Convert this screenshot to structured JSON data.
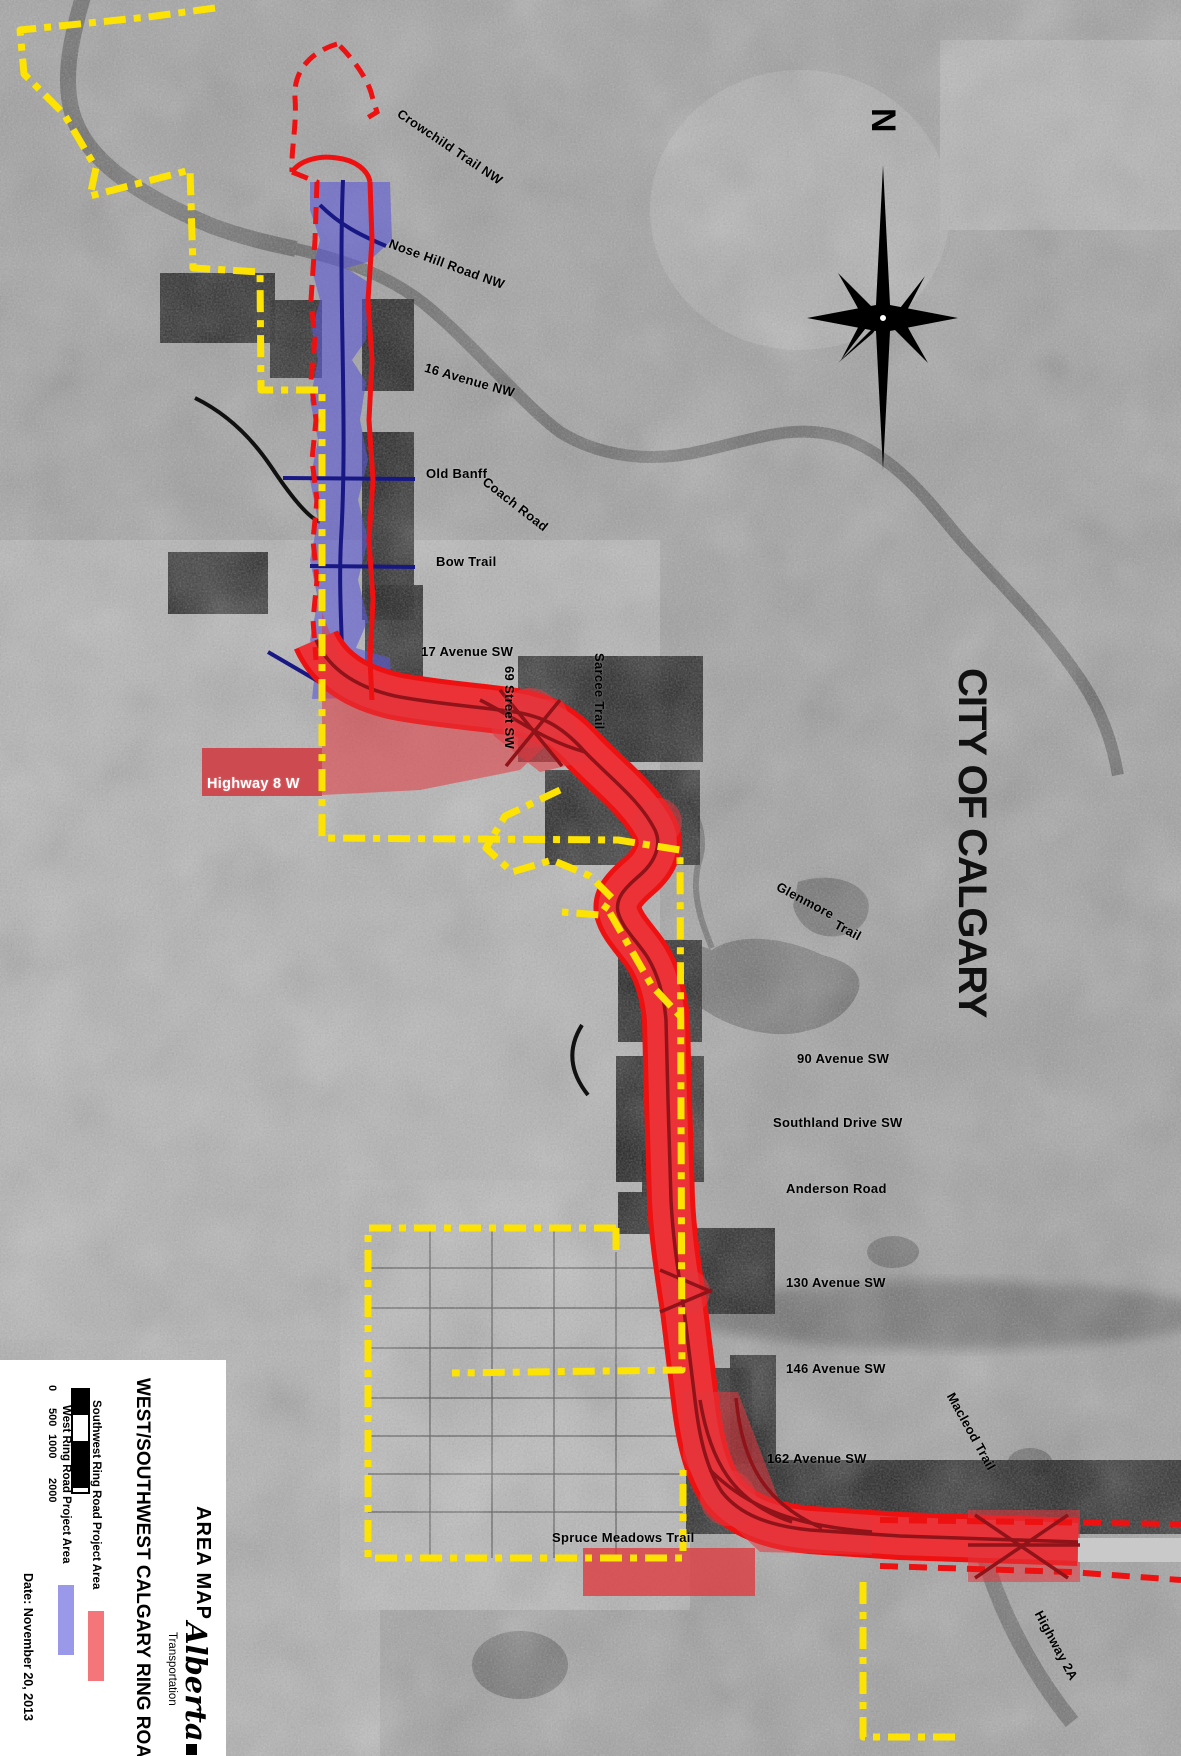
{
  "page": {
    "width": 1181,
    "height": 1756
  },
  "map": {
    "city_label": {
      "text": "CITY OF CALGARY"
    },
    "compass": {
      "north_label": "N"
    },
    "road_labels": [
      {
        "text": "Crowchild Trail NW",
        "x": 403,
        "y": 106,
        "angle": 34
      },
      {
        "text": "Nose Hill Road NW",
        "x": 392,
        "y": 236,
        "angle": 20
      },
      {
        "text": "16 Avenue NW",
        "x": 427,
        "y": 360,
        "angle": 16
      },
      {
        "text": "Old Banff",
        "x": 426,
        "y": 466,
        "angle": 0
      },
      {
        "text": "Coach Road",
        "x": 489,
        "y": 474,
        "angle": 38
      },
      {
        "text": "Bow Trail",
        "x": 436,
        "y": 554,
        "angle": 0
      },
      {
        "text": "17 Avenue SW",
        "x": 421,
        "y": 644,
        "angle": 0
      },
      {
        "text": "69 Street SW",
        "x": 517,
        "y": 666,
        "angle": 90
      },
      {
        "text": "Sarcee Trail",
        "x": 607,
        "y": 653,
        "angle": 90
      },
      {
        "text": "Highway 8 W",
        "x": 207,
        "y": 776,
        "angle": 0,
        "color": "#ffffff",
        "size": 14.5
      },
      {
        "text": "Glenmore",
        "x": 781,
        "y": 879,
        "angle": 28
      },
      {
        "text": "Trail",
        "x": 839,
        "y": 917,
        "angle": 28
      },
      {
        "text": "90 Avenue SW",
        "x": 797,
        "y": 1051,
        "angle": 0
      },
      {
        "text": "Southland Drive SW",
        "x": 773,
        "y": 1115,
        "angle": 0
      },
      {
        "text": "Anderson Road",
        "x": 786,
        "y": 1181,
        "angle": 0
      },
      {
        "text": "130 Avenue SW",
        "x": 786,
        "y": 1275,
        "angle": 0
      },
      {
        "text": "146 Avenue SW",
        "x": 786,
        "y": 1361,
        "angle": 0
      },
      {
        "text": "162 Avenue SW",
        "x": 767,
        "y": 1451,
        "angle": 0
      },
      {
        "text": "Spruce Meadows Trail",
        "x": 552,
        "y": 1530,
        "angle": 0
      },
      {
        "text": "Macleod Trail",
        "x": 957,
        "y": 1390,
        "angle": 61
      },
      {
        "text": "Highway 2A",
        "x": 1045,
        "y": 1608,
        "angle": 62
      }
    ]
  },
  "legend": {
    "area_map_label": "AREA MAP",
    "title": "WEST/SOUTHWEST CALGARY RING ROAD",
    "items": [
      {
        "id": "southwest",
        "label": "Southwest Ring Road Project Area",
        "swatch_color": "#f4767b"
      },
      {
        "id": "west",
        "label": "West Ring Road Project Area",
        "swatch_color": "#9a98e8"
      }
    ],
    "scale_bar": {
      "ticks": [
        "0",
        "500",
        "1000",
        "2000"
      ]
    },
    "date_label": "Date: November 20, 2013",
    "logo": {
      "brand": "Alberta",
      "dept": "Transportation"
    }
  },
  "colors": {
    "boundary_yellow": "#fce303",
    "project_red": "#ee1111",
    "project_red_fill": "rgba(236,60,66,0.62)",
    "dark_red": "#8f1318",
    "west_blue_fill": "rgba(92,88,214,0.6)",
    "navy": "#181884"
  }
}
